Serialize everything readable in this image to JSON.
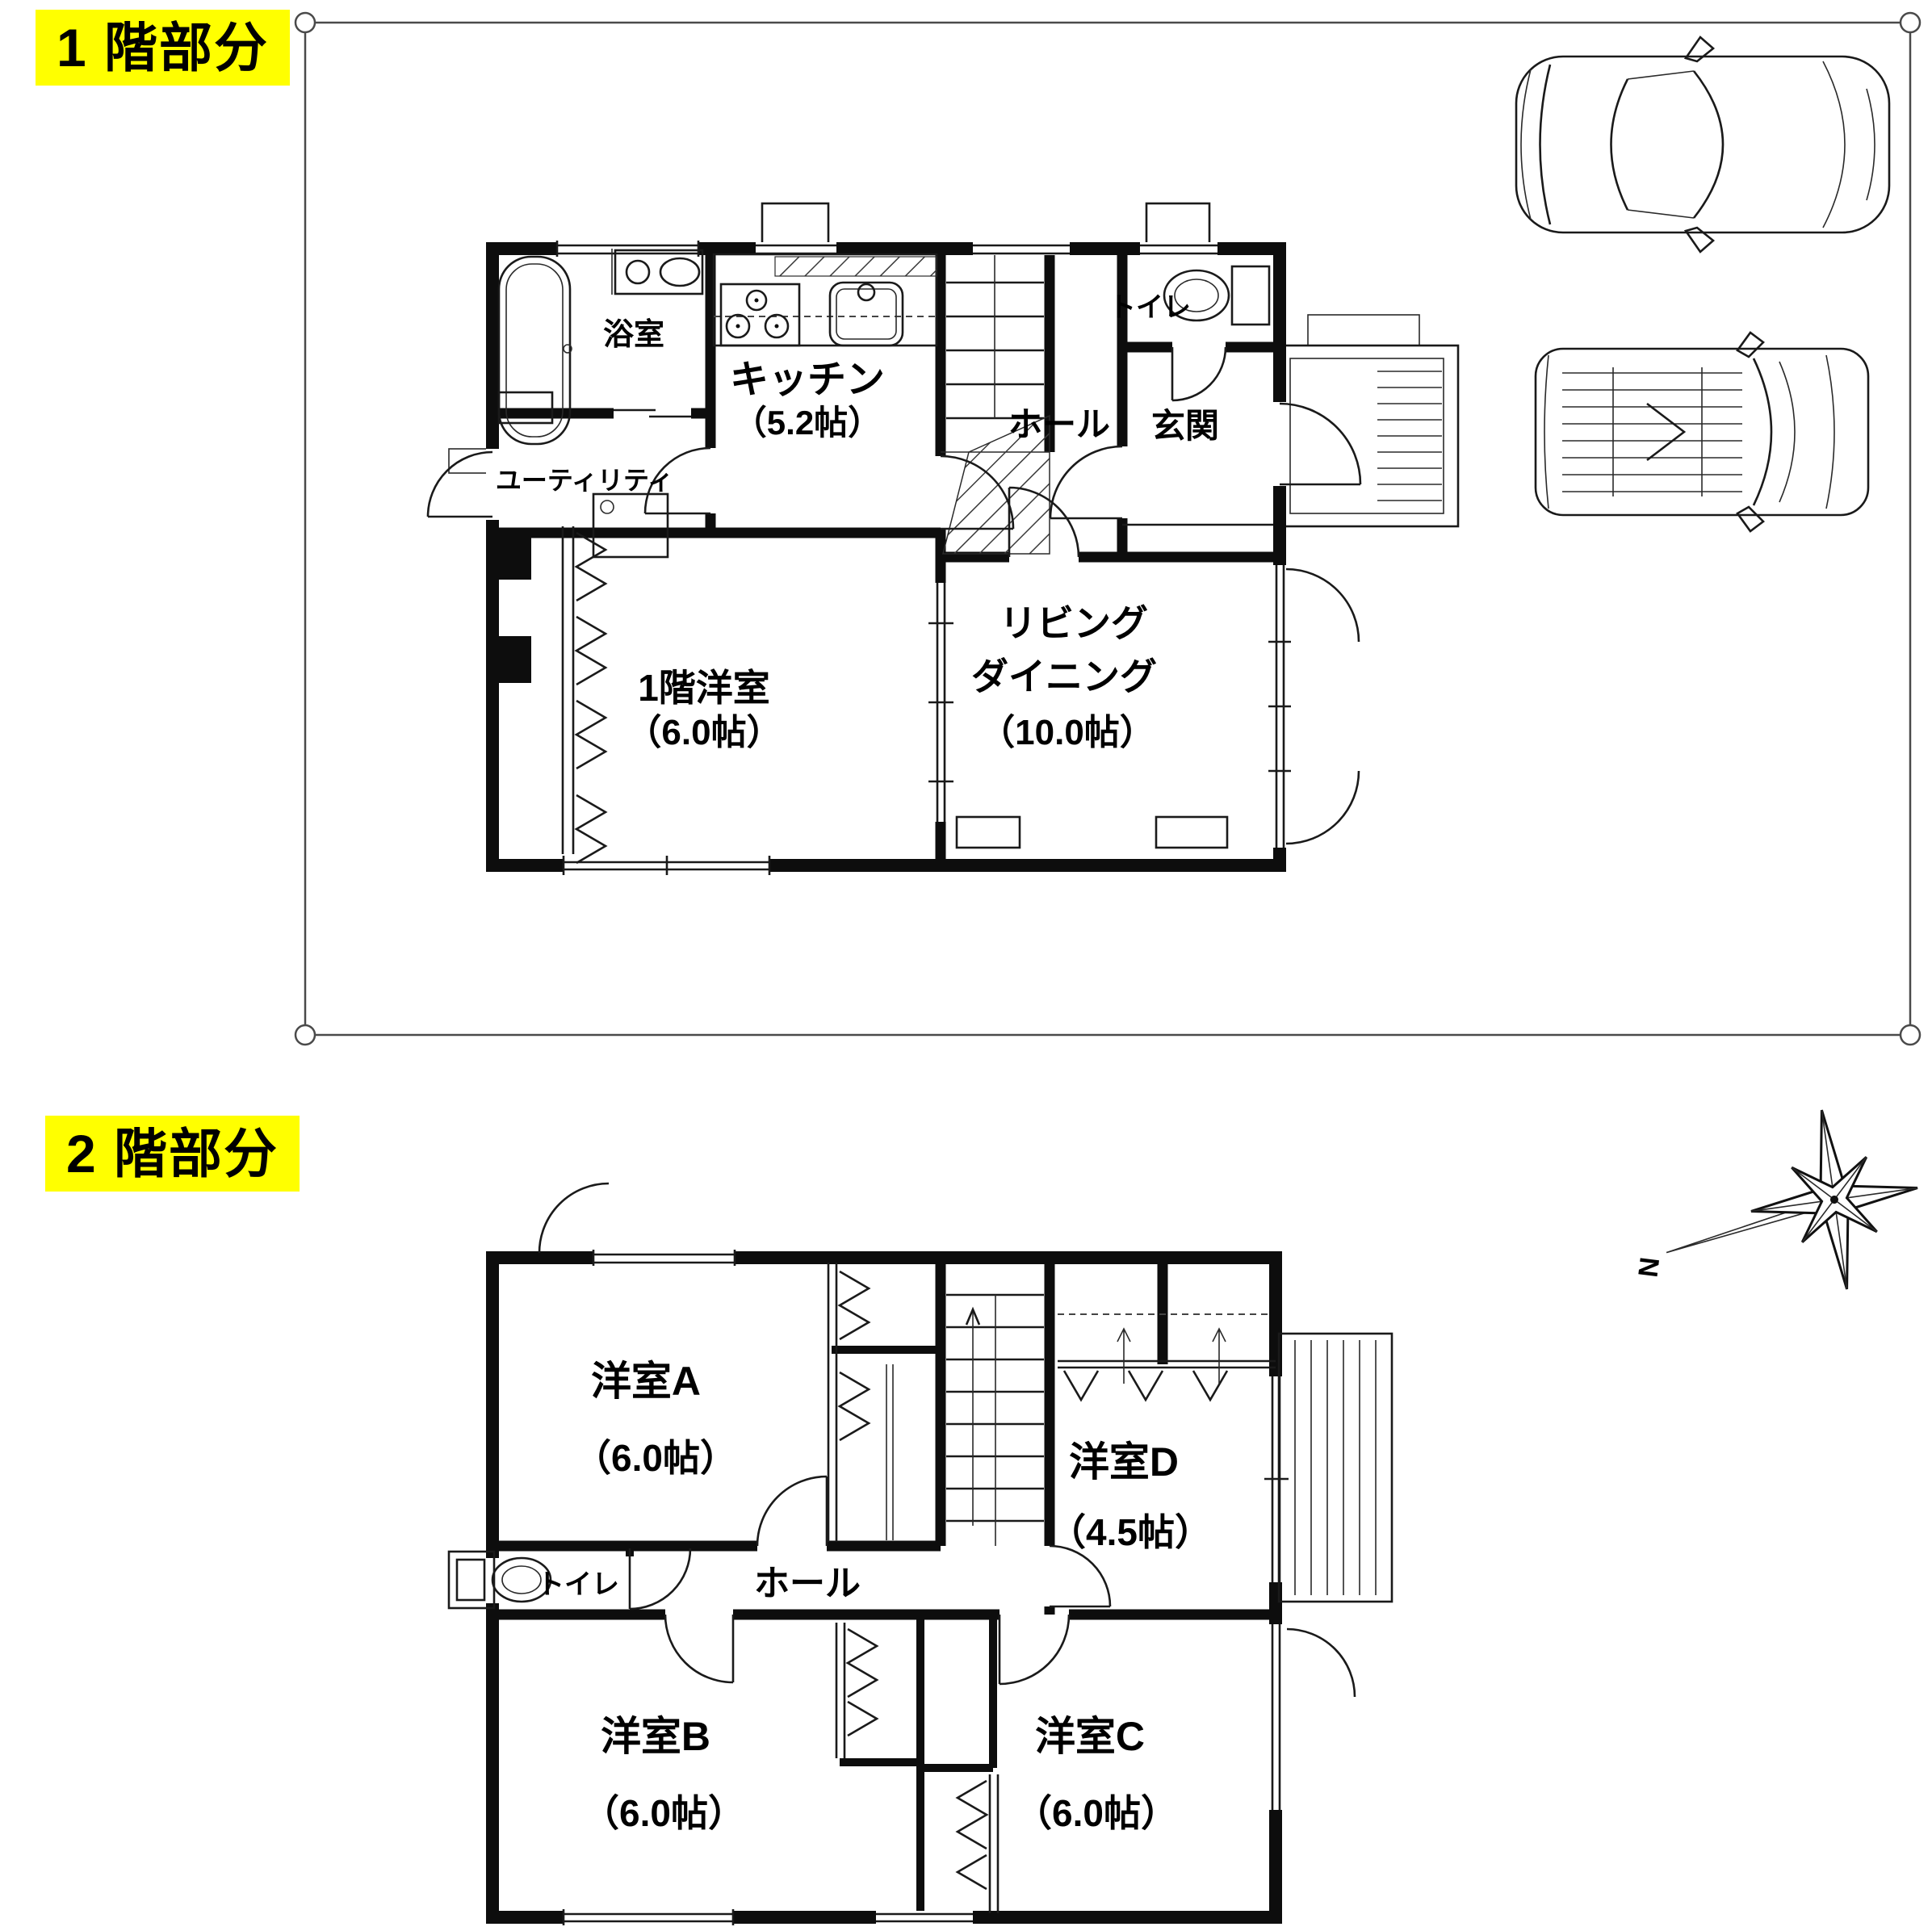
{
  "colors": {
    "highlight": "#ffff00",
    "wall": "#0d0d0d",
    "line": "#1a1a1a"
  },
  "floor1": {
    "label": "1 階部分",
    "rooms": {
      "bath": {
        "name": "浴室"
      },
      "kitchen": {
        "name": "キッチン",
        "size": "（5.2帖）"
      },
      "utility": {
        "name": "ユーティリティ"
      },
      "toilet": {
        "name": "トイレ"
      },
      "hall": {
        "name": "ホール"
      },
      "entrance": {
        "name": "玄関"
      },
      "western_room": {
        "name": "1階洋室",
        "size": "（6.0帖）"
      },
      "living_dining": {
        "line1": "リビング",
        "line2": "ダイニング",
        "size": "（10.0帖）"
      }
    }
  },
  "floor2": {
    "label": "2 階部分",
    "rooms": {
      "room_a": {
        "name": "洋室A",
        "size": "（6.0帖）"
      },
      "room_b": {
        "name": "洋室B",
        "size": "（6.0帖）"
      },
      "room_c": {
        "name": "洋室C",
        "size": "（6.0帖）"
      },
      "room_d": {
        "name": "洋室D",
        "size": "（4.5帖）"
      },
      "toilet": {
        "name": "トイレ"
      },
      "hall": {
        "name": "ホール"
      }
    },
    "compass": {
      "north_label": "N"
    }
  }
}
